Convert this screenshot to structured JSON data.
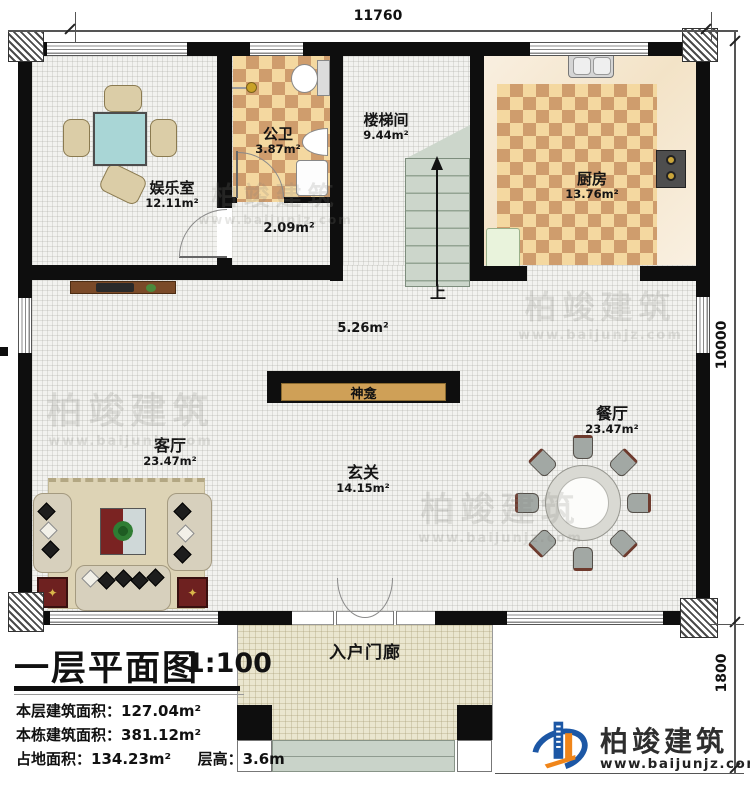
{
  "dimensions": {
    "top": "11760",
    "right": "10000",
    "bottom_right": "1800"
  },
  "rooms": {
    "entertainment": {
      "name": "娱乐室",
      "area": "12.11m²"
    },
    "bathroom": {
      "name": "公卫",
      "area": "3.87m²"
    },
    "vestibule": {
      "area": "2.09m²"
    },
    "stairwell": {
      "name": "楼梯间",
      "area": "9.44m²"
    },
    "kitchen": {
      "name": "厨房",
      "area": "13.76m²"
    },
    "open_area": {
      "area": "5.26m²"
    },
    "shrine": {
      "name": "神龛"
    },
    "living": {
      "name": "客厅",
      "area": "23.47m²"
    },
    "dining": {
      "name": "餐厅",
      "area": "23.47m²"
    },
    "foyer": {
      "name": "玄关",
      "area": "14.15m²"
    },
    "porch": {
      "name": "入户门廊"
    }
  },
  "stairs": {
    "up_label": "上"
  },
  "title_block": {
    "title": "一层平面图",
    "scale": "1:100",
    "line1_label": "本层建筑面积：",
    "line1_value": "127.04m²",
    "line2_label": "本栋建筑面积：",
    "line2_value": "381.12m²",
    "line3_label": "占地面积：",
    "line3_value": "134.23m²",
    "line3b_label": "层高：",
    "line3b_value": "3.6m"
  },
  "brand": {
    "name": "柏竣建筑",
    "website": "www.baijunjz.com"
  },
  "watermark": {
    "name": "柏竣建筑",
    "website": "www.baijunjz.com"
  },
  "icons": {
    "end_table_star": "✦"
  },
  "colors": {
    "wall": "#0e0e0e",
    "checker_light": "#f4d8a0",
    "checker_dark": "#cf9d6d",
    "stair": "#ccd6cb",
    "shrine_tan": "#cfa057",
    "brand_blue": "#1c57a5",
    "brand_orange": "#f08519"
  }
}
